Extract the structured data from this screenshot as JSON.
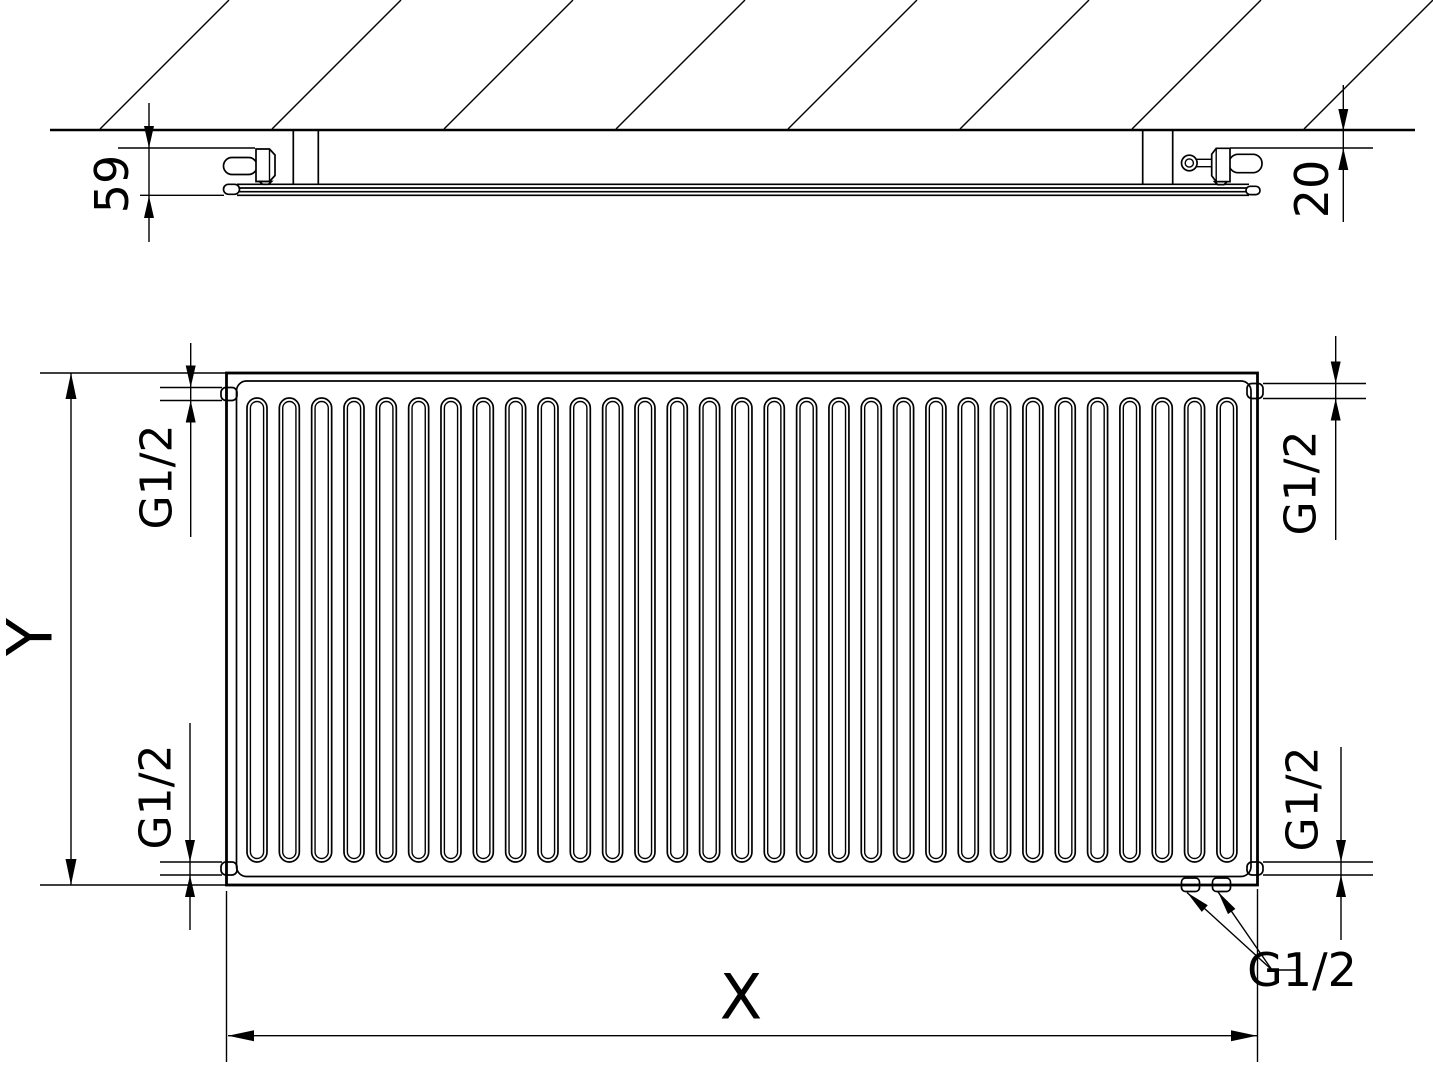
{
  "page": {
    "background_color": "#ffffff",
    "line_color": "#000000"
  },
  "top_view": {
    "dim_depth": "59",
    "dim_wall_gap": "20",
    "hatch_line_count": 8
  },
  "front_view": {
    "dim_height": "Y",
    "dim_width": "X",
    "rib_count": 31,
    "thread_top_left": "G1/2",
    "thread_bottom_left": "G1/2",
    "thread_top_right": "G1/2",
    "thread_bottom_right": "G1/2",
    "thread_bottom_connections": "G1/2"
  }
}
